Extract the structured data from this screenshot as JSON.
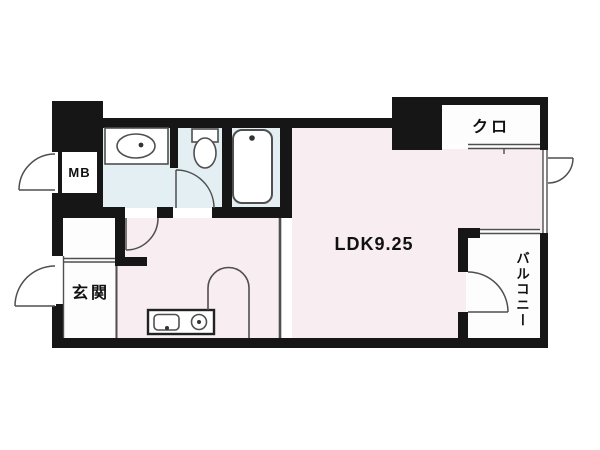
{
  "floorplan": {
    "type": "apartment-floor-plan",
    "rooms": {
      "ldk": {
        "label": "LDK9.25"
      },
      "entrance": {
        "label": "玄関"
      },
      "closet": {
        "label": "クロ"
      },
      "balcony": {
        "label": "バルコニー"
      },
      "meter_box": {
        "label": "MB"
      }
    },
    "colors": {
      "wall": "#161616",
      "line": "#4f4f4f",
      "sanitary_fill": "#e3eff3",
      "room_fill": "#f8edf0",
      "white_fill": "#fdfdfd",
      "fixture_fill": "#ffffff"
    }
  }
}
